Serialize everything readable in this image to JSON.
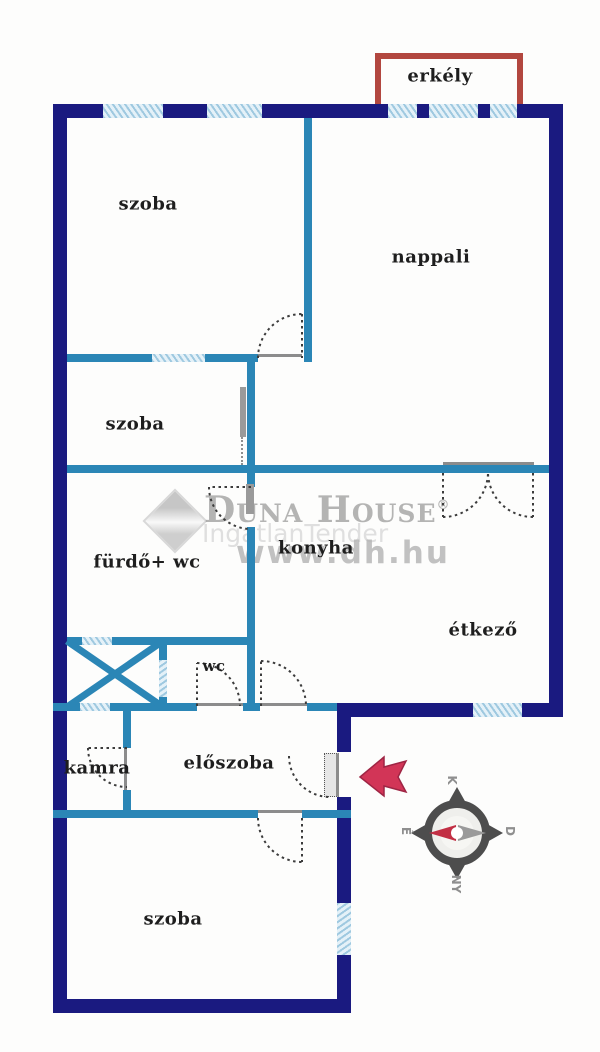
{
  "plan": {
    "rooms": [
      {
        "id": "erkely",
        "label": "erkély"
      },
      {
        "id": "szoba-felso",
        "label": "szoba"
      },
      {
        "id": "nappali",
        "label": "nappali"
      },
      {
        "id": "szoba-kozepso",
        "label": "szoba"
      },
      {
        "id": "furdo-wc",
        "label": "fürdő+ wc"
      },
      {
        "id": "konyha",
        "label": "konyha"
      },
      {
        "id": "etkezo",
        "label": "étkező"
      },
      {
        "id": "wc",
        "label": "wc"
      },
      {
        "id": "kamra",
        "label": "kamra"
      },
      {
        "id": "eloszoba",
        "label": "előszoba"
      },
      {
        "id": "szoba-also",
        "label": "szoba"
      }
    ],
    "watermark": {
      "brand": "Duna House",
      "reg": "®",
      "tagline": "IngatlanTender",
      "url": "www.dh.hu"
    },
    "compass": {
      "top": "K",
      "right": "D",
      "bottom": "NY",
      "left": "É"
    },
    "colors": {
      "outer_wall": "#1a1a80",
      "inner_wall": "#2b86b6",
      "window": "#cde3f0",
      "balcony_red": "#b2473f",
      "entrance_arrow": "#d23557"
    }
  }
}
